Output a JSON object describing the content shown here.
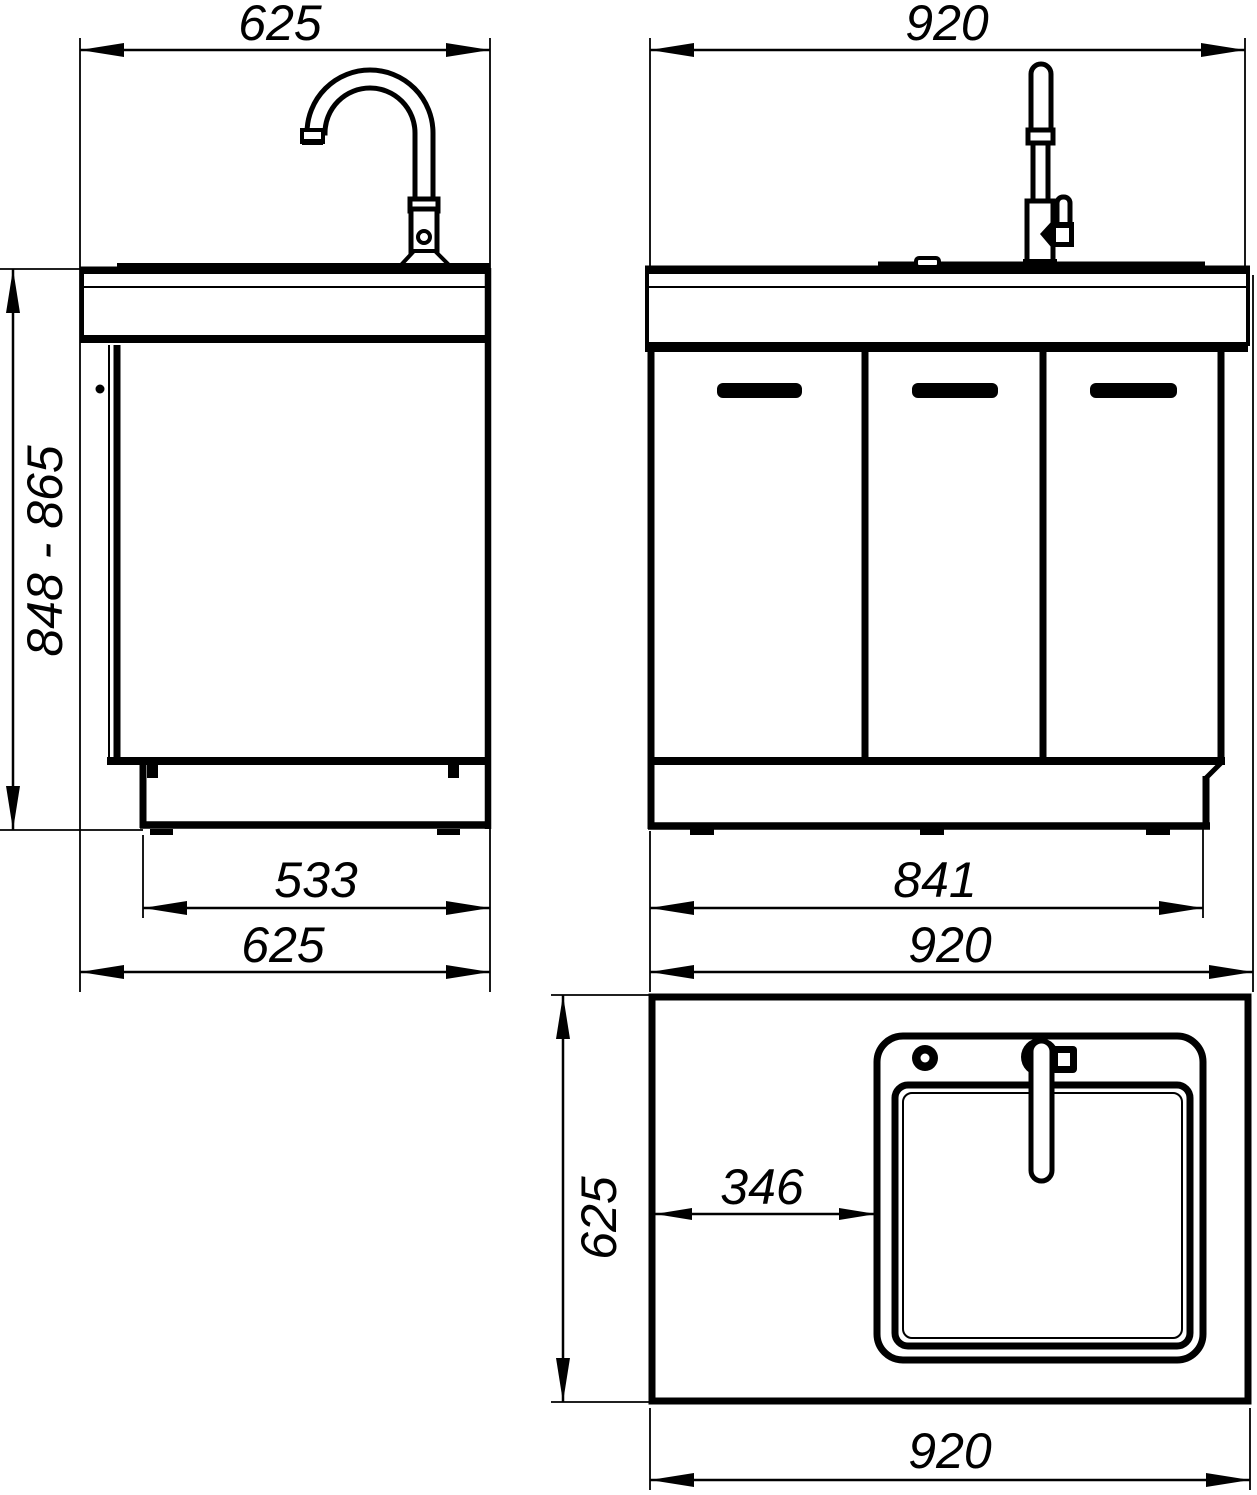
{
  "colors": {
    "background": "#ffffff",
    "ink": "#000000"
  },
  "views": {
    "side": {
      "dim_top_width": "625",
      "dim_height_range": "848 - 865",
      "dim_plinth_depth": "533",
      "dim_overall_depth": "625"
    },
    "front": {
      "dim_top_width": "920",
      "dim_plinth_width": "841",
      "dim_overall_width": "920"
    },
    "plan": {
      "dim_depth": "625",
      "dim_sink_offset": "346",
      "dim_overall_width": "920"
    }
  }
}
